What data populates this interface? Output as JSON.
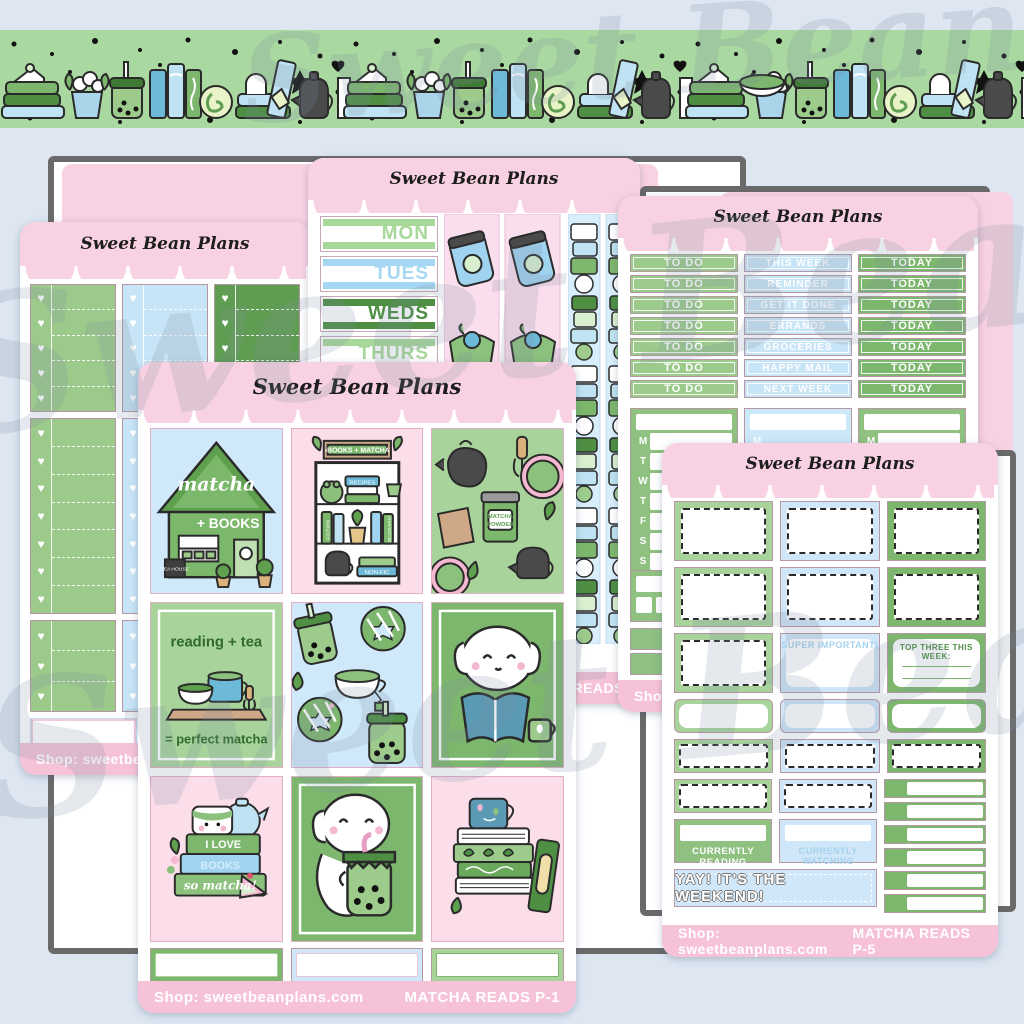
{
  "brand": {
    "logo": "Sweet Bean Plans",
    "watermark": "Sweet Bean Plans"
  },
  "colors": {
    "background": "#dde6f1",
    "banner_green": "#a9d8a1",
    "header_pink": "#f8d2e2",
    "footer_pink": "#f6c2d8",
    "green_light": "#a8d49c",
    "green_mid": "#7db76d",
    "green_dark": "#5f9e52",
    "blue_light": "#cfe7f8"
  },
  "banner": {
    "icons": [
      "book-stack-icon",
      "cake-slice-icon",
      "plant-pot-icon",
      "boba-cup-icon",
      "vertical-books-icon",
      "swiss-roll-icon",
      "teabag-book-icon",
      "teapot-icon",
      "bookend-icon",
      "mug-icon",
      "star-icon",
      "heart-icon",
      "dot-icon"
    ]
  },
  "sheets": {
    "left": {
      "logo": "Sweet Bean Plans",
      "shop": "Shop: sweetbeanplans.com"
    },
    "days": {
      "logo": "Sweet Bean Plans",
      "items": [
        "MON",
        "TUES",
        "WEDS",
        "THURS"
      ],
      "footer_label": "MATCHA READS"
    },
    "todo": {
      "logo": "Sweet Bean Plans",
      "col_todo": [
        "TO DO",
        "TO DO",
        "TO DO",
        "TO DO",
        "TO DO",
        "TO DO",
        "TO DO"
      ],
      "col_week": [
        "THIS WEEK",
        "REMINDER",
        "GET IT DONE",
        "ERRANDS",
        "GROCERIES",
        "HAPPY MAIL",
        "NEXT WEEK"
      ],
      "col_today": [
        "TODAY",
        "TODAY",
        "TODAY",
        "TODAY",
        "TODAY",
        "TODAY",
        "TODAY"
      ],
      "weekdays": [
        "M",
        "T",
        "W",
        "T",
        "F",
        "S",
        "S"
      ],
      "shop": "Shop: sweetbeanplans.com"
    },
    "p1": {
      "logo": "Sweet Bean Plans",
      "shop": "Shop: sweetbeanplans.com",
      "label": "MATCHA READS P-1",
      "tiles": {
        "house_line1": "matcha",
        "house_line2": "+ BOOKS",
        "house_sign": "TEA HOUSE",
        "shelf_sign": "›BOOKS + MATCHA",
        "shelf_recipes": "RECIPES",
        "shelf_fiction": "FICTION",
        "shelf_bio": "BIOGRAPHY",
        "shelf_nonfic": "NON-FIC",
        "jar_label1": "MATCHA",
        "jar_label2": "POWDER",
        "reading_line1": "reading + tea",
        "reading_line2": "= perfect matcha",
        "books_love1": "I LOVE",
        "books_love2": "BOOKS",
        "books_love3": "so matcha!"
      }
    },
    "p5": {
      "logo": "Sweet Bean Plans",
      "shop": "Shop: sweetbeanplans.com",
      "label": "MATCHA READS P-5",
      "super_important": "SUPER IMPORTANT!",
      "top_three": "TOP THREE THIS WEEK:",
      "currently_reading": "CURRENTLY READING",
      "currently_watching": "CURRENTLY WATCHING",
      "weekend": "YAY! IT'S THE WEEKEND!"
    }
  }
}
